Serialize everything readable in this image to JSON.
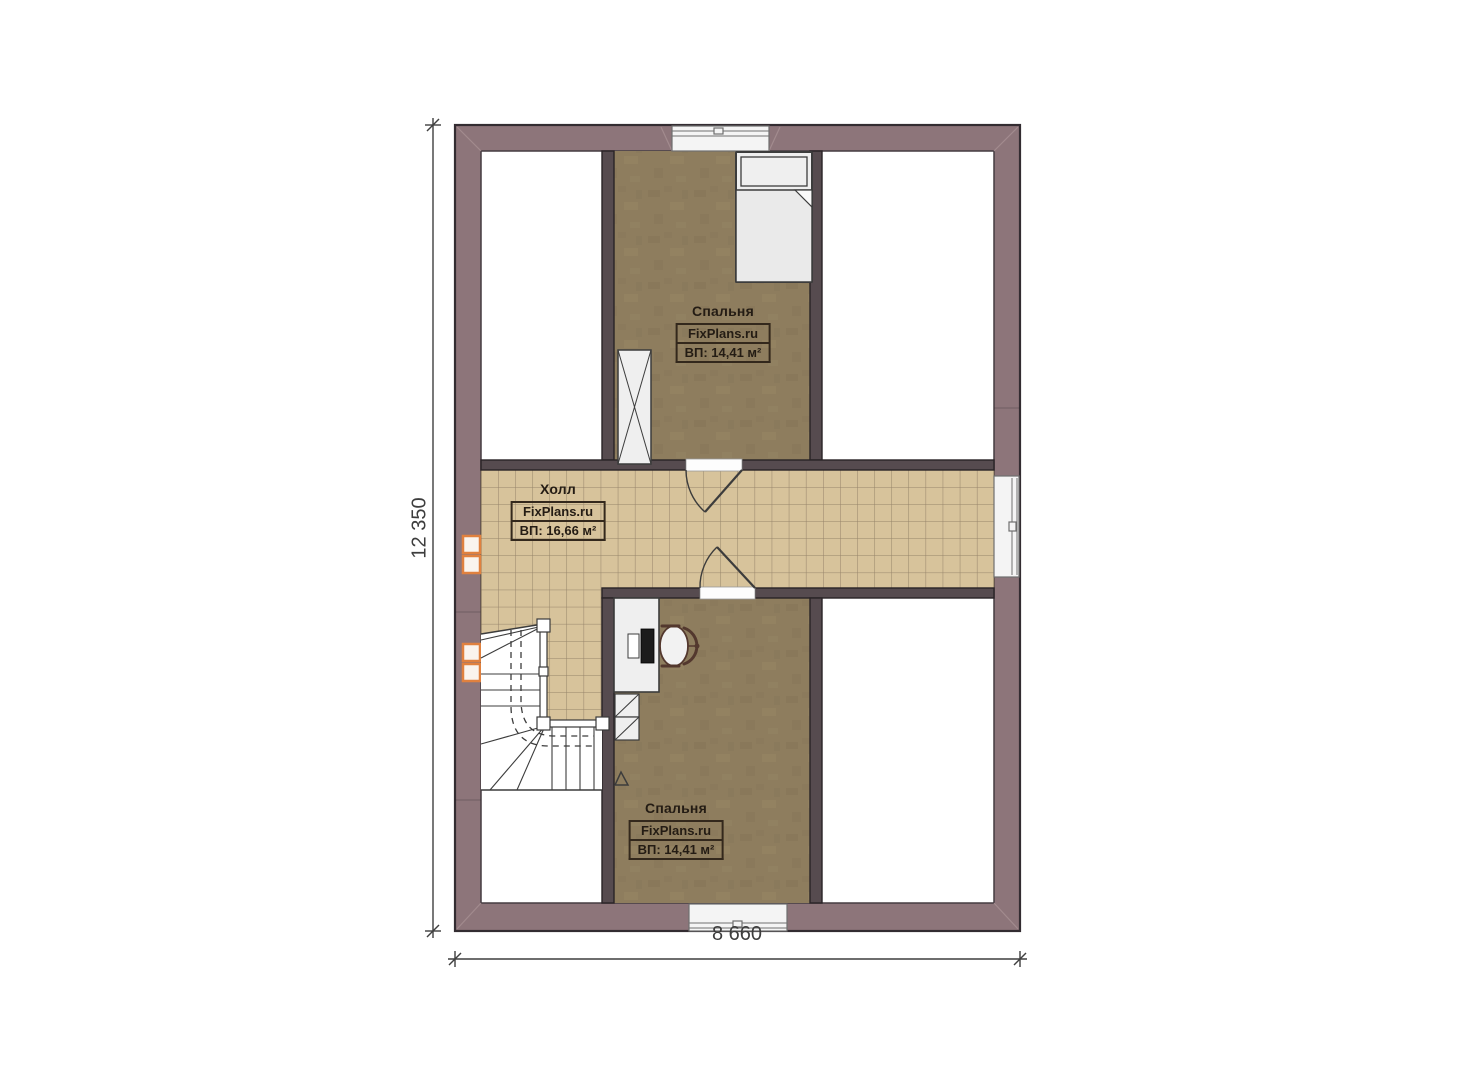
{
  "rooms": {
    "bedroom_top": {
      "name": "Спальня",
      "brand": "FixPlans.ru",
      "area": "ВП: 14,41 м²"
    },
    "hall": {
      "name": "Холл",
      "brand": "FixPlans.ru",
      "area": "ВП: 16,66 м²"
    },
    "bedroom_bottom": {
      "name": "Спальня",
      "brand": "FixPlans.ru",
      "area": "ВП: 14,41 м²"
    }
  },
  "dimensions": {
    "vertical": "12 350",
    "horizontal": "8 660"
  },
  "colors": {
    "exterior_wall": "#8d757a",
    "interior_wall": "#564b4f",
    "wall_outline": "#332c31",
    "bedroom_floor": "#8e7d5e",
    "tile_floor": "#d7c39b",
    "tile_grid": "#8a7860",
    "furniture_fill": "#efefef",
    "furniture_outline": "#3c3c3c",
    "window_accent": "#e0813f",
    "dimension_line": "#3f3f3f",
    "label_text": "#241c14",
    "label_border": "#33281c"
  }
}
